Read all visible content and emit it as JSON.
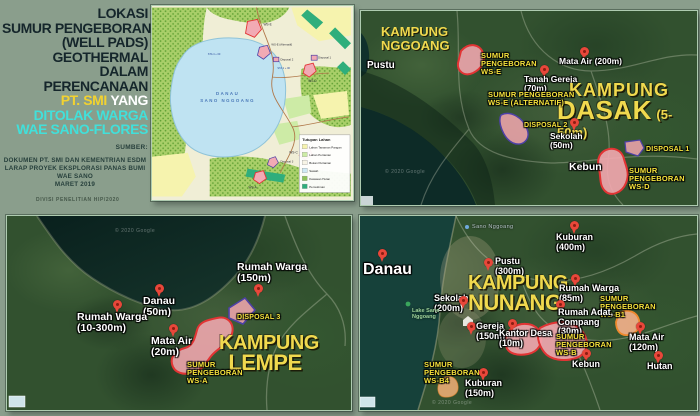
{
  "colors": {
    "background": "#8a9e8c",
    "title_dark": "#15262b",
    "title_yellow": "#f2d230",
    "title_cyan": "#41e0da",
    "label_yellow": "#f6e33c",
    "kampung_yellow": "#f0d94e",
    "pin_red": "#e8473a",
    "wellpad_fill": "#f2aab4",
    "wellpad_stroke_red": "#e23434",
    "wellpad_stroke_purple": "#4d41a6",
    "wellpad_stroke_orange": "#ef8a2e"
  },
  "title": {
    "lines": [
      "LOKASI",
      "SUMUR PENGEBORAN",
      "(WELL PADS)",
      "GEOTHERMAL",
      "DALAM",
      "PERENCANAAN"
    ],
    "highlight": "PT. SMI",
    "highlight_rest": "YANG",
    "cyan_lines": [
      "DITOLAK WARGA",
      "WAE SANO-FLORES"
    ],
    "source_label": "SUMBER:",
    "source_lines": [
      "DOKUMEN PT. SMI DAN KEMENTRIAN ESDM",
      "LARAP PROYEK EKSPLORASI PANAS BUMI WAE SANO",
      "MARET 2019"
    ],
    "credit": "DIVISI PENELITIAN HIP/2020"
  },
  "landuse": {
    "lake_label_1": "DANAU",
    "lake_label_2": "SANO NGGOANG",
    "legend_title": "Tutupan Lahan",
    "legend_items": [
      {
        "label": "Lahan Tanaman Pangan",
        "color": "#f6f3ae"
      },
      {
        "label": "Lahan Pertanian",
        "color": "#cdeba6"
      },
      {
        "label": "Bukan Pertanian",
        "color": "#f7f4e6"
      },
      {
        "label": "Sawah",
        "color": "#cfe9f4"
      },
      {
        "label": "Kawasan Hutan",
        "color": "#8fc35a"
      },
      {
        "label": "Pemukiman",
        "color": "#2fae7c"
      }
    ],
    "sites": {
      "ws_e": "WS-E",
      "ws_e_alt": "WS-E (Alternatif)",
      "disposal2": "Disposal 2",
      "disposal1": "Disposal 1",
      "ws_d": "WS-D",
      "ws_c": "WS-C",
      "disposal3": "Disposal 3",
      "ws_a": "WS-A"
    },
    "sta_labels": [
      "STA 1 + 00",
      "STA 4 + 00"
    ]
  },
  "panels": {
    "dasak": {
      "region": "KAMPUNG\nNGGOANG",
      "title": {
        "line1": "KAMPUNG",
        "line2": "DASAK",
        "suffix": "(5-50m)"
      },
      "labels": [
        {
          "text": "Pustu"
        },
        {
          "text": "SUMUR\nPENGEBORAN\nWS-E"
        },
        {
          "text": "Mata Air (200m)"
        },
        {
          "text": "Tanah Gereja\n(70m)"
        },
        {
          "text": "SUMUR PENGEBORAN\nWS-E (ALTERNATIF)"
        },
        {
          "text": "DISPOSAL 2"
        },
        {
          "text": "Sekolah\n(50m)"
        },
        {
          "text": "DISPOSAL 1"
        },
        {
          "text": "Kebun"
        },
        {
          "text": "SUMUR\nPENGEBORAN\nWS-D"
        }
      ]
    },
    "lempe": {
      "title": {
        "line1": "KAMPUNG",
        "line2": "LEMPE"
      },
      "labels": [
        {
          "text": "Rumah Warga\n(150m)"
        },
        {
          "text": "Danau\n(50m)"
        },
        {
          "text": "Rumah Warga\n(10-300m)"
        },
        {
          "text": "Mata Air\n(20m)"
        },
        {
          "text": "DISPOSAL 3"
        },
        {
          "text": "SUMUR\nPENGEBORAN\nWS-A"
        }
      ]
    },
    "nunang": {
      "title": {
        "line1": "KAMPUNG",
        "line2": "NUNANG"
      },
      "labels": [
        {
          "text": "Danau"
        },
        {
          "text": "Kuburan\n(400m)"
        },
        {
          "text": "Pustu\n(300m)"
        },
        {
          "text": "Sekolah\n(200m)"
        },
        {
          "text": "Rumah Warga\n(85m)"
        },
        {
          "text": "SUMUR\nPENGEBORAN\nWS-B1"
        },
        {
          "text": "Rumah Adat,\nCompang\n(30m)"
        },
        {
          "text": "Gereja\n(150m)"
        },
        {
          "text": "Kantor Desa\n(10m)"
        },
        {
          "text": "SUMUR\nPENGEBORAN\nWS-B"
        },
        {
          "text": "Mata Air\n(120m)"
        },
        {
          "text": "Kebun"
        },
        {
          "text": "Hutan"
        },
        {
          "text": "SUMUR\nPENGEBORAN\nWS-B4"
        },
        {
          "text": "Kuburan\n(150m)"
        },
        {
          "text": "Lake Sano\nNggoang"
        },
        {
          "text": "Sano Nggoang"
        }
      ]
    }
  },
  "watermark": "© 2020 Google"
}
